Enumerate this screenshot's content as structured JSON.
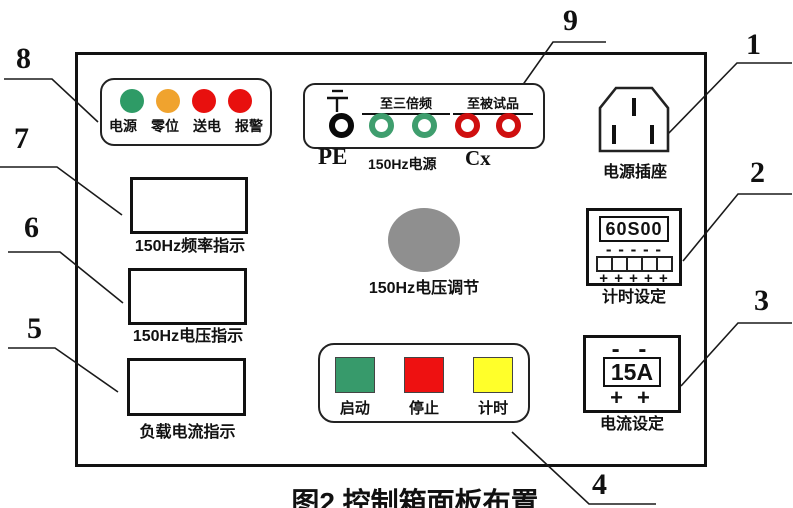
{
  "figure": {
    "caption": "图2 控制箱面板布置"
  },
  "callouts": {
    "c1": "1",
    "c2": "2",
    "c3": "3",
    "c4": "4",
    "c5": "5",
    "c6": "6",
    "c7": "7",
    "c8": "8",
    "c9": "9"
  },
  "indicator_panel": {
    "lights": [
      {
        "name": "power",
        "label": "电源",
        "color": "#2e9b66"
      },
      {
        "name": "zero-position",
        "label": "零位",
        "color": "#f0a32e"
      },
      {
        "name": "energize",
        "label": "送电",
        "color": "#e8100e"
      },
      {
        "name": "alarm",
        "label": "报警",
        "color": "#e8100e"
      }
    ]
  },
  "terminal_panel": {
    "header_triple": "至三倍频",
    "header_test": "至被试品",
    "pe_label": "PE",
    "source_label": "150Hz电源",
    "cx_label": "Cx",
    "pe_ring_color": "#0a0a0a",
    "triple_ring_color": "#3f9e6e",
    "test_ring_color": "#cf0f0f"
  },
  "power_socket": {
    "label": "电源插座"
  },
  "timer_setting": {
    "display": "60S00",
    "dec_row": "- - - - -",
    "inc_row": "+ + + + +",
    "label": "计时设定"
  },
  "current_setting": {
    "dec_row": "- -",
    "display": "15A",
    "inc_row": "+ +",
    "label": "电流设定"
  },
  "indicators": [
    {
      "label": "150Hz频率指示"
    },
    {
      "label": "150Hz电压指示"
    },
    {
      "label": "负载电流指示"
    }
  ],
  "knob": {
    "label": "150Hz电压调节",
    "color": "#8f8f8f"
  },
  "button_panel": {
    "buttons": [
      {
        "name": "start",
        "label": "启动",
        "color": "#379a6b"
      },
      {
        "name": "stop",
        "label": "停止",
        "color": "#ee1111"
      },
      {
        "name": "timing",
        "label": "计时",
        "color": "#ffff2a"
      }
    ]
  }
}
